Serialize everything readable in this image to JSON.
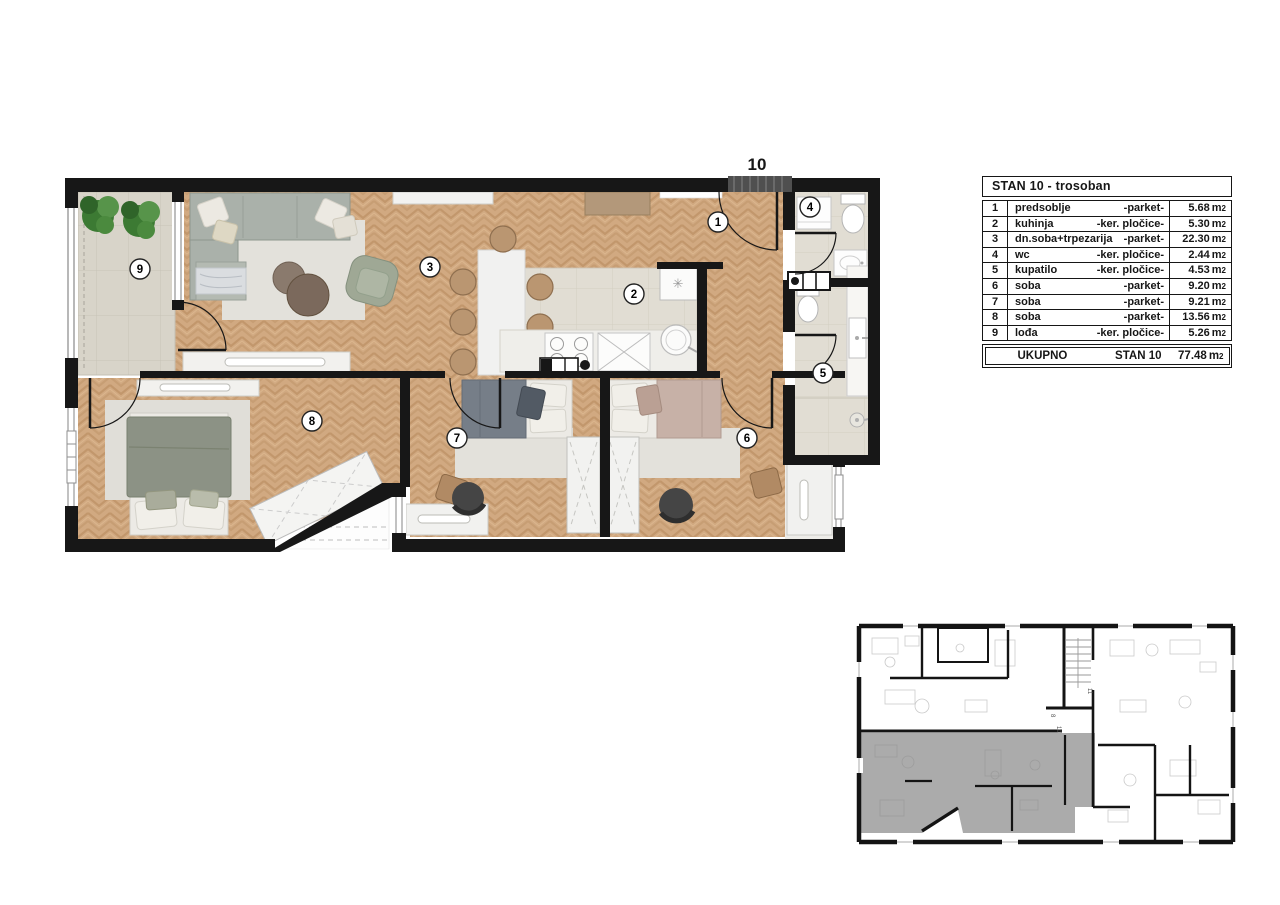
{
  "plan": {
    "entrance_label": "10",
    "title_unit": "STAN 10"
  },
  "legend": {
    "title": "STAN 10 - trosoban",
    "rows": [
      {
        "num": "1",
        "name": "predsoblje",
        "floor": "-parket-",
        "area": "5.68",
        "unit_base": "m",
        "unit_exp": "2"
      },
      {
        "num": "2",
        "name": "kuhinja",
        "floor": "-ker. pločice-",
        "area": "5.30",
        "unit_base": "m",
        "unit_exp": "2"
      },
      {
        "num": "3",
        "name": "dn.soba+trpezarija",
        "floor": "-parket-",
        "area": "22.30",
        "unit_base": "m",
        "unit_exp": "2"
      },
      {
        "num": "4",
        "name": "wc",
        "floor": "-ker. pločice-",
        "area": "2.44",
        "unit_base": "m",
        "unit_exp": "2"
      },
      {
        "num": "5",
        "name": "kupatilo",
        "floor": "-ker. pločice-",
        "area": "4.53",
        "unit_base": "m",
        "unit_exp": "2"
      },
      {
        "num": "6",
        "name": "soba",
        "floor": "-parket-",
        "area": "9.20",
        "unit_base": "m",
        "unit_exp": "2"
      },
      {
        "num": "7",
        "name": "soba",
        "floor": "-parket-",
        "area": "9.21",
        "unit_base": "m",
        "unit_exp": "2"
      },
      {
        "num": "8",
        "name": "soba",
        "floor": "-parket-",
        "area": "13.56",
        "unit_base": "m",
        "unit_exp": "2"
      },
      {
        "num": "9",
        "name": "lođa",
        "floor": "-ker. pločice-",
        "area": "5.26",
        "unit_base": "m",
        "unit_exp": "2"
      }
    ],
    "total": {
      "label": "UKUPNO",
      "stan": "STAN 10",
      "area": "77.48",
      "unit_base": "m",
      "unit_exp": "2"
    }
  },
  "key_plan": {
    "stair_label_a": "8",
    "stair_label_b": "10",
    "neighbor_label": "11"
  },
  "colors": {
    "wall": "#171717",
    "wood": "#d1a981",
    "tile": "#e1ddd3",
    "loggia_tile": "#d8d4c9",
    "highlight_gray": "#ababab",
    "plant_green": "#3f7d35"
  }
}
